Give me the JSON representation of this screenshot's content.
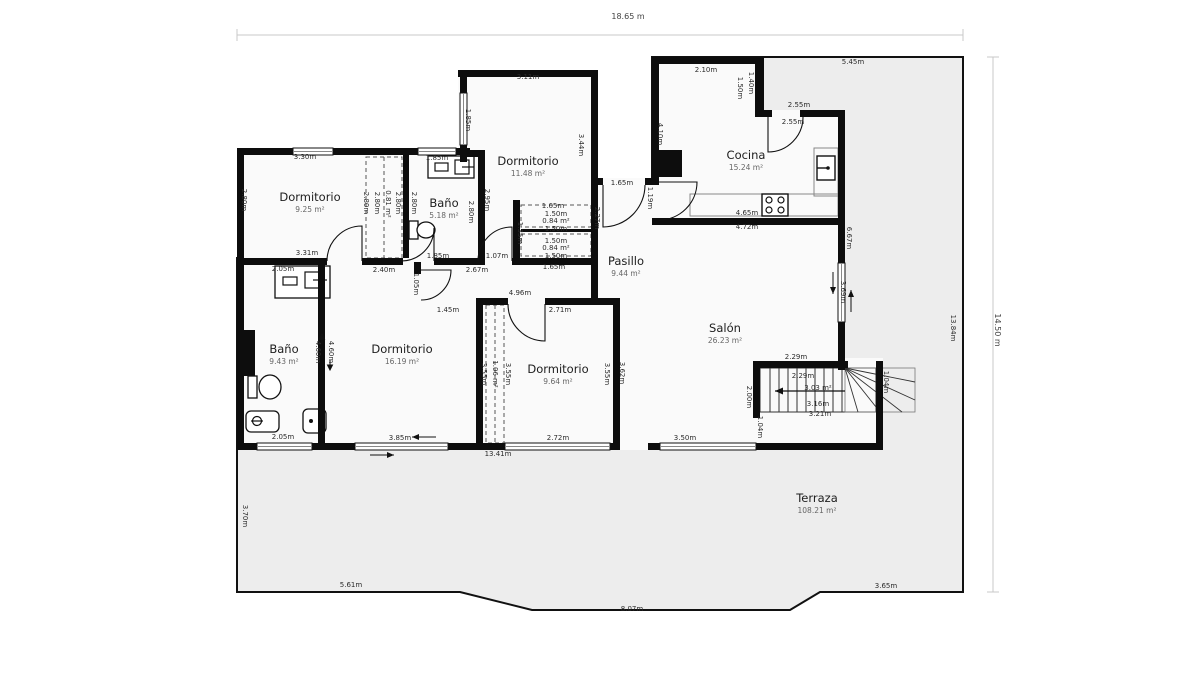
{
  "plan": {
    "title": "floor-plan",
    "overall_dimensions": {
      "top_width": "18.65 m",
      "right_height": "14.50 m",
      "right_inner_height": "13.84m"
    },
    "rooms": [
      {
        "name": "Dormitorio",
        "area": "9.25 m²",
        "x": 310,
        "y": 202
      },
      {
        "name": "Baño",
        "area": "5.18 m²",
        "x": 444,
        "y": 208
      },
      {
        "name": "Dormitorio",
        "area": "11.48 m²",
        "x": 528,
        "y": 166
      },
      {
        "name": "Cocina",
        "area": "15.24 m²",
        "x": 746,
        "y": 160
      },
      {
        "name": "Pasillo",
        "area": "9.44 m²",
        "x": 626,
        "y": 266
      },
      {
        "name": "Salón",
        "area": "26.23 m²",
        "x": 725,
        "y": 333
      },
      {
        "name": "Baño",
        "area": "9.43 m²",
        "x": 284,
        "y": 354
      },
      {
        "name": "Dormitorio",
        "area": "16.19 m²",
        "x": 402,
        "y": 354
      },
      {
        "name": "Dormitorio",
        "area": "9.64 m²",
        "x": 558,
        "y": 374
      },
      {
        "name": "Terraza",
        "area": "108.21 m²",
        "x": 817,
        "y": 503
      }
    ],
    "dimensions": [
      {
        "text": "18.65 m",
        "x": 628,
        "y": 17,
        "rot": 0,
        "big": true
      },
      {
        "text": "14.50 m",
        "x": 997,
        "y": 330,
        "rot": 90,
        "big": true
      },
      {
        "text": "13.84m",
        "x": 953,
        "y": 328,
        "rot": 90
      },
      {
        "text": "3.30m",
        "x": 305,
        "y": 157,
        "rot": 0
      },
      {
        "text": "2.80m",
        "x": 244,
        "y": 200,
        "rot": 90
      },
      {
        "text": "3.31m",
        "x": 307,
        "y": 253,
        "rot": 0
      },
      {
        "text": "2.80m",
        "x": 366,
        "y": 203,
        "rot": 90
      },
      {
        "text": "2.80m",
        "x": 377,
        "y": 203,
        "rot": 90
      },
      {
        "text": "0.81 m²",
        "x": 388,
        "y": 204,
        "rot": 90
      },
      {
        "text": "2.80m",
        "x": 398,
        "y": 203,
        "rot": 90
      },
      {
        "text": "2.80m",
        "x": 414,
        "y": 203,
        "rot": 90
      },
      {
        "text": "2.80m",
        "x": 471,
        "y": 212,
        "rot": 90
      },
      {
        "text": "1.85m",
        "x": 437,
        "y": 158,
        "rot": 0
      },
      {
        "text": "1.85m",
        "x": 438,
        "y": 256,
        "rot": 0
      },
      {
        "text": "1.07m",
        "x": 497,
        "y": 256,
        "rot": 0
      },
      {
        "text": "2.67m",
        "x": 477,
        "y": 270,
        "rot": 0
      },
      {
        "text": "2.40m",
        "x": 384,
        "y": 270,
        "rot": 0
      },
      {
        "text": "3.11m",
        "x": 528,
        "y": 77,
        "rot": 0
      },
      {
        "text": "1.85m",
        "x": 468,
        "y": 120,
        "rot": 90
      },
      {
        "text": "3.44m",
        "x": 581,
        "y": 145,
        "rot": 90
      },
      {
        "text": "2.95m",
        "x": 487,
        "y": 200,
        "rot": 90
      },
      {
        "text": "1.35m",
        "x": 520,
        "y": 233,
        "rot": 90
      },
      {
        "text": "1.65m",
        "x": 553,
        "y": 206,
        "rot": 0
      },
      {
        "text": "1.50m",
        "x": 556,
        "y": 214,
        "rot": 0
      },
      {
        "text": "0.84 m²",
        "x": 556,
        "y": 221,
        "rot": 0
      },
      {
        "text": "1.50m",
        "x": 556,
        "y": 229,
        "rot": 0
      },
      {
        "text": "1.50m",
        "x": 556,
        "y": 241,
        "rot": 0
      },
      {
        "text": "0.84 m²",
        "x": 556,
        "y": 248,
        "rot": 0
      },
      {
        "text": "1.50m",
        "x": 556,
        "y": 256,
        "rot": 0
      },
      {
        "text": "1.65m",
        "x": 554,
        "y": 267,
        "rot": 0
      },
      {
        "text": "2.27m",
        "x": 597,
        "y": 218,
        "rot": 90
      },
      {
        "text": "1.65m",
        "x": 622,
        "y": 183,
        "rot": 0
      },
      {
        "text": "1.19m",
        "x": 650,
        "y": 198,
        "rot": 90
      },
      {
        "text": "2.10m",
        "x": 706,
        "y": 70,
        "rot": 0
      },
      {
        "text": "1.50m",
        "x": 740,
        "y": 88,
        "rot": 90
      },
      {
        "text": "1.40m",
        "x": 751,
        "y": 83,
        "rot": 90
      },
      {
        "text": "2.55m",
        "x": 799,
        "y": 105,
        "rot": 0
      },
      {
        "text": "2.55m",
        "x": 793,
        "y": 122,
        "rot": 0
      },
      {
        "text": "5.45m",
        "x": 853,
        "y": 62,
        "rot": 0
      },
      {
        "text": "4.10m",
        "x": 660,
        "y": 134,
        "rot": 90
      },
      {
        "text": "4.65m",
        "x": 747,
        "y": 213,
        "rot": 0
      },
      {
        "text": "4.72m",
        "x": 747,
        "y": 227,
        "rot": 0
      },
      {
        "text": "6.67m",
        "x": 849,
        "y": 238,
        "rot": 90
      },
      {
        "text": "3.69m",
        "x": 843,
        "y": 292,
        "rot": 90
      },
      {
        "text": "2.29m",
        "x": 796,
        "y": 357,
        "rot": 0
      },
      {
        "text": "2.29m",
        "x": 803,
        "y": 376,
        "rot": 0
      },
      {
        "text": "3.03 m²",
        "x": 818,
        "y": 388,
        "rot": 0
      },
      {
        "text": "3.16m",
        "x": 818,
        "y": 404,
        "rot": 0
      },
      {
        "text": "3.21m",
        "x": 820,
        "y": 414,
        "rot": 0
      },
      {
        "text": "2.00m",
        "x": 749,
        "y": 397,
        "rot": 90
      },
      {
        "text": "1.04m",
        "x": 886,
        "y": 382,
        "rot": 90
      },
      {
        "text": "1.04m",
        "x": 760,
        "y": 427,
        "rot": 90
      },
      {
        "text": "3.50m",
        "x": 685,
        "y": 438,
        "rot": 0
      },
      {
        "text": "3.62m",
        "x": 622,
        "y": 373,
        "rot": 90
      },
      {
        "text": "4.96m",
        "x": 520,
        "y": 293,
        "rot": 0
      },
      {
        "text": "2.71m",
        "x": 560,
        "y": 310,
        "rot": 0
      },
      {
        "text": "3.55m",
        "x": 484,
        "y": 374,
        "rot": 90
      },
      {
        "text": "1.06 m²",
        "x": 495,
        "y": 374,
        "rot": 90
      },
      {
        "text": "3.55m",
        "x": 508,
        "y": 374,
        "rot": 90
      },
      {
        "text": "3.55m",
        "x": 607,
        "y": 374,
        "rot": 90
      },
      {
        "text": "2.72m",
        "x": 558,
        "y": 438,
        "rot": 0
      },
      {
        "text": "13.41m",
        "x": 498,
        "y": 454,
        "rot": 0
      },
      {
        "text": "1.45m",
        "x": 448,
        "y": 310,
        "rot": 0
      },
      {
        "text": "1.05m",
        "x": 416,
        "y": 284,
        "rot": 90
      },
      {
        "text": "3.85m",
        "x": 400,
        "y": 438,
        "rot": 0
      },
      {
        "text": "2.05m",
        "x": 283,
        "y": 269,
        "rot": 0
      },
      {
        "text": "4.60m",
        "x": 318,
        "y": 352,
        "rot": 90
      },
      {
        "text": "4.60m",
        "x": 331,
        "y": 352,
        "rot": 90
      },
      {
        "text": "2.05m",
        "x": 283,
        "y": 437,
        "rot": 0
      },
      {
        "text": "3.70m",
        "x": 245,
        "y": 516,
        "rot": 90
      },
      {
        "text": "5.61m",
        "x": 351,
        "y": 585,
        "rot": 0
      },
      {
        "text": "8.07m",
        "x": 632,
        "y": 609,
        "rot": 0
      },
      {
        "text": "3.65m",
        "x": 886,
        "y": 586,
        "rot": 0
      }
    ],
    "colors": {
      "wall": "#0d0d0d",
      "terrace_fill": "#ededed",
      "room_fill": "#fafafa",
      "dimension_line": "#c8c8c8"
    }
  }
}
